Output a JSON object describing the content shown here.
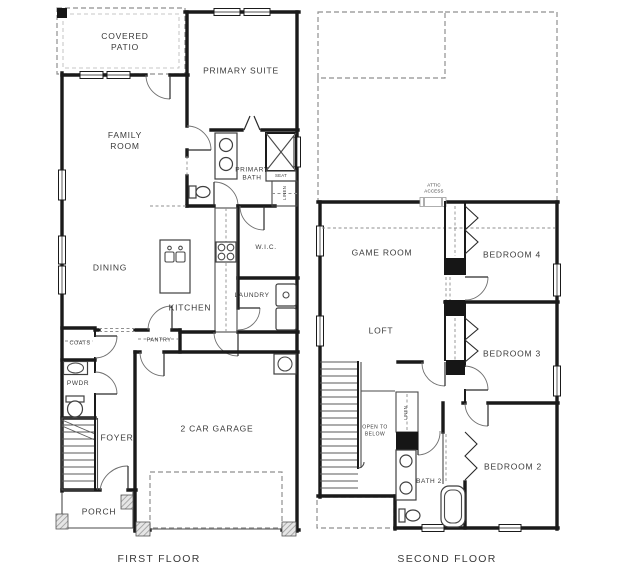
{
  "page": {
    "background": "#ffffff"
  },
  "colors": {
    "wall": "#1a1a1a",
    "dashed_outline": "#8f8f8f",
    "fixture": "#3f3f3f",
    "label_text": "#3a3a3a",
    "hatch_fill": "#9a9a9a"
  },
  "first_floor": {
    "caption": "FIRST FLOOR",
    "rooms": {
      "covered_patio": "COVERED PATIO",
      "primary_suite": "PRIMARY SUITE",
      "family_room": "FAMILY ROOM",
      "primary_bath": "PRIMARY BATH",
      "seat": "SEAT",
      "linen": "LINEN",
      "wic": "W.I.C.",
      "dining": "DINING",
      "kitchen": "KITCHEN",
      "laundry": "LAUNDRY",
      "coats": "COATS",
      "pantry": "PANTRY",
      "pwdr": "PWDR",
      "foyer": "FOYER",
      "garage": "2 CAR GARAGE",
      "porch": "PORCH"
    }
  },
  "second_floor": {
    "caption": "SECOND FLOOR",
    "rooms": {
      "attic_access": "ATTIC ACCESS",
      "game_room": "GAME ROOM",
      "bedroom4": "BEDROOM 4",
      "loft": "LOFT",
      "bedroom3": "BEDROOM 3",
      "open_to_below": "OPEN TO BELOW",
      "linen": "LINEN",
      "bath2": "BATH 2",
      "bedroom2": "BEDROOM 2"
    }
  }
}
